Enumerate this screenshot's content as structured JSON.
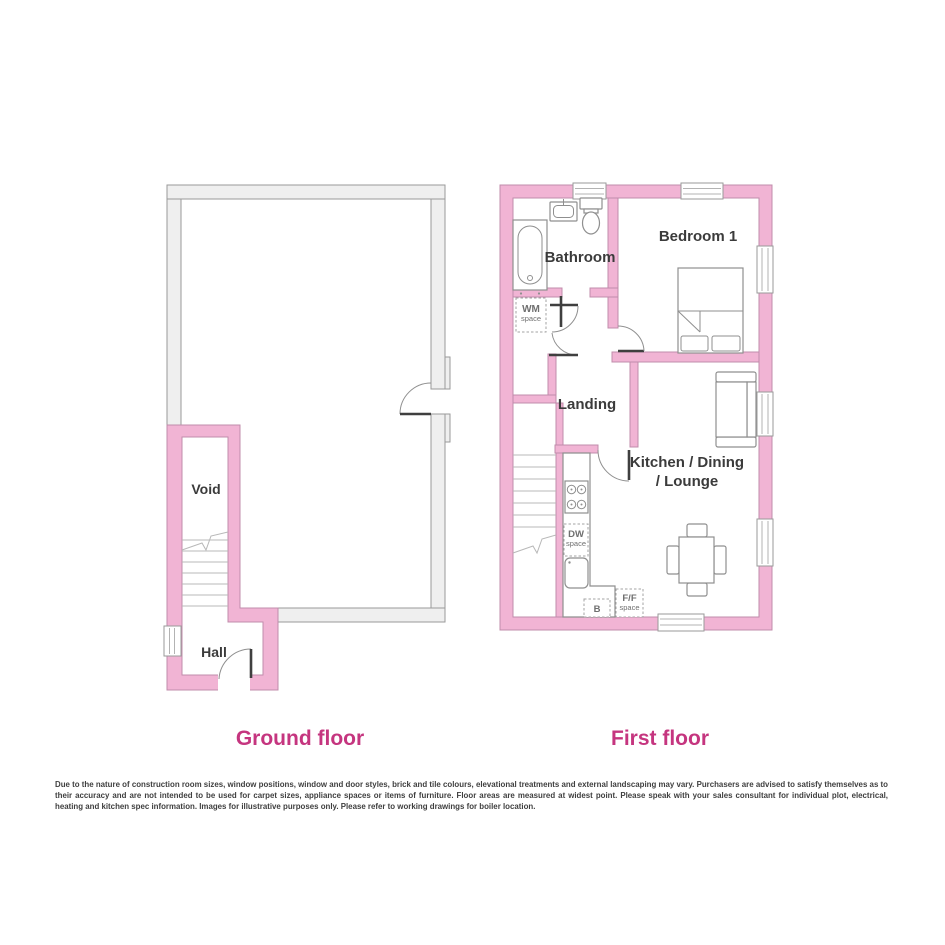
{
  "titles": {
    "ground": "Ground floor",
    "first": "First floor"
  },
  "rooms": {
    "void": "Void",
    "hall": "Hall",
    "bathroom": "Bathroom",
    "bedroom1": "Bedroom 1",
    "landing": "Landing",
    "kitchen_line1": "Kitchen / Dining",
    "kitchen_line2": "/ Lounge"
  },
  "spaces": {
    "wm_abbr": "WM",
    "wm_sub": "space",
    "dw_abbr": "DW",
    "dw_sub": "space",
    "ff_abbr": "F/F",
    "ff_sub": "space",
    "boiler_abbr": "B"
  },
  "colors": {
    "wall_pink": "#F1B4D4",
    "wall_pink_stroke": "#C08CAB",
    "wall_gray": "#EFEFEF",
    "wall_gray_stroke": "#9A9A9A",
    "title_color": "#C5357F",
    "label_text": "#3B3B3B",
    "space_text": "#6F6F6F"
  },
  "disclaimer": {
    "text": "Due to the nature of construction room sizes, window positions, window and door styles, brick and tile colours, elevational treatments and external landscaping may vary. Purchasers are advised to satisfy themselves as to their accuracy and are not intended to be used for carpet sizes, appliance spaces or items of furniture. Floor areas are measured at widest point. Please speak with your sales consultant for individual plot, electrical, heating and kitchen spec information. Images for illustrative purposes only. Please refer to working drawings for boiler location."
  }
}
